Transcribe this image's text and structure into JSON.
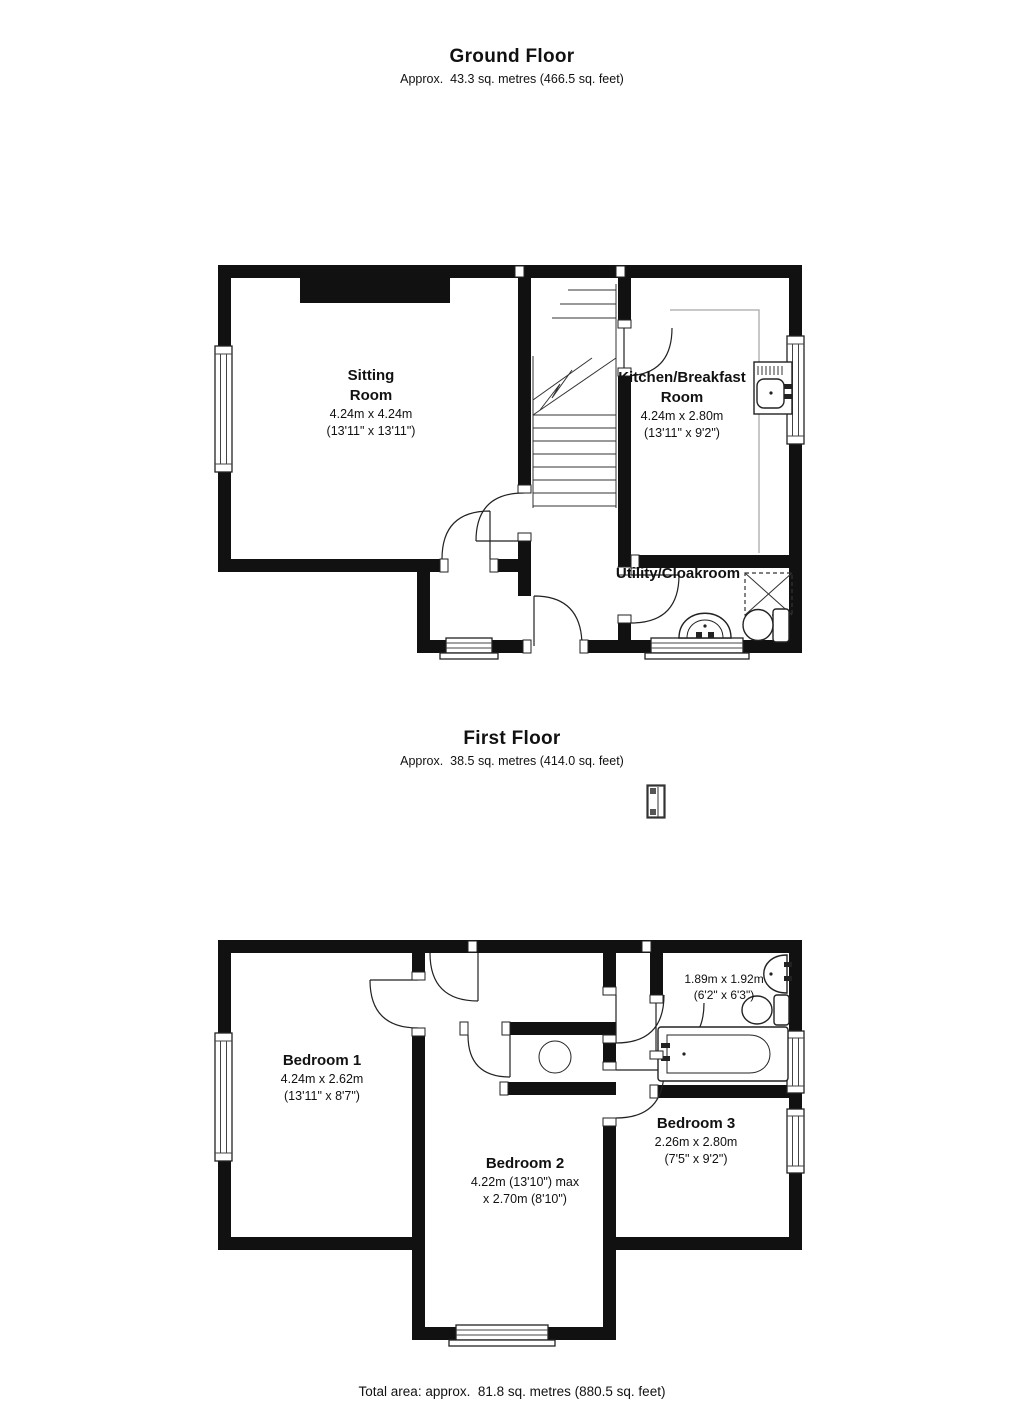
{
  "colors": {
    "wall": "#111111",
    "line": "#222222",
    "counter": "#b5b5b5",
    "background": "#ffffff"
  },
  "ground_floor": {
    "title": "Ground Floor",
    "area": "Approx.  43.3 sq. metres (466.5 sq. feet)",
    "icons": [
      "stairs-icon",
      "sink-icon",
      "toilet-icon",
      "washbasin-icon",
      "appliance-space-icon",
      "window-symbol",
      "door-arc"
    ],
    "rooms": {
      "sitting_room": {
        "name_line1": "Sitting",
        "name_line2": "Room",
        "dims_metric": "4.24m x 4.24m",
        "dims_imperial": "(13'11\" x 13'11\")"
      },
      "kitchen": {
        "name_line1": "Kitchen/Breakfast",
        "name_line2": "Room",
        "dims_metric": "4.24m x 2.80m",
        "dims_imperial": "(13'11\" x 9'2\")"
      },
      "utility": {
        "name": "Utility/Cloakroom"
      }
    }
  },
  "first_floor": {
    "title": "First Floor",
    "area": "Approx.  38.5 sq. metres (414.0 sq. feet)",
    "icons": [
      "bath-icon",
      "toilet-icon",
      "washbasin-icon",
      "round-feature-icon",
      "window-symbol",
      "door-arc",
      "landing-window-icon"
    ],
    "rooms": {
      "bedroom_1": {
        "name": "Bedroom 1",
        "dims_metric": "4.24m x 2.62m",
        "dims_imperial": "(13'11\" x 8'7\")"
      },
      "bedroom_2": {
        "name": "Bedroom 2",
        "dims_line1": "4.22m (13'10\") max",
        "dims_line2": "x 2.70m (8'10\")"
      },
      "bedroom_3": {
        "name": "Bedroom 3",
        "dims_metric": "2.26m x 2.80m",
        "dims_imperial": "(7'5\" x 9'2\")"
      },
      "bathroom": {
        "dims_metric": "1.89m x 1.92m",
        "dims_imperial": "(6'2\" x 6'3\")"
      }
    }
  },
  "footer": {
    "total_area": "Total area: approx.  81.8 sq. metres (880.5 sq. feet)"
  }
}
